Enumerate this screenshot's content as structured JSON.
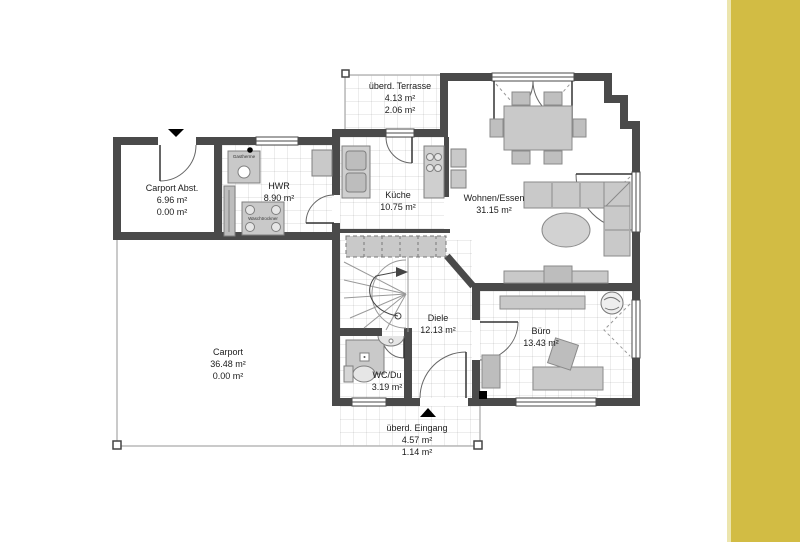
{
  "page": {
    "type": "floor-plan",
    "colors": {
      "wall": "#4a4a4a",
      "furniture": "#c9c9c9",
      "accent_band": "#d2bc44",
      "accent_band_edge": "#ece5ad"
    }
  },
  "rooms": {
    "terrasse": {
      "name": "überd. Terrasse",
      "area1": "4.13 m²",
      "area2": "2.06 m²"
    },
    "carport_abst": {
      "name": "Carport Abst.",
      "area1": "6.96 m²",
      "area2": "0.00 m²"
    },
    "hwr": {
      "name": "HWR",
      "area1": "8.90 m²"
    },
    "kueche": {
      "name": "Küche",
      "area1": "10.75 m²"
    },
    "wohnen_essen": {
      "name": "Wohnen/Essen",
      "area1": "31.15 m²"
    },
    "diele": {
      "name": "Diele",
      "area1": "12.13 m²"
    },
    "buero": {
      "name": "Büro",
      "area1": "13.43 m²"
    },
    "wc_du": {
      "name": "WC/Du",
      "area1": "3.19 m²"
    },
    "carport": {
      "name": "Carport",
      "area1": "36.48 m²",
      "area2": "0.00 m²"
    },
    "eingang": {
      "name": "überd. Eingang",
      "area1": "4.57 m²",
      "area2": "1.14 m²"
    }
  },
  "appliances": {
    "gastherme": "Gastherme",
    "washer": "Waschtrockner"
  }
}
